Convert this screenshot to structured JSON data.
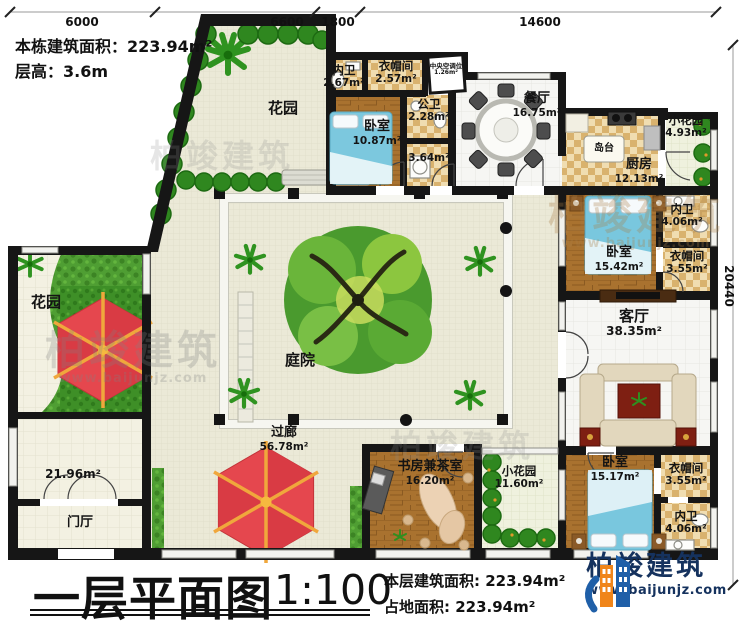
{
  "header": {
    "building_area_label": "本栋建筑面积：223.94m²",
    "floor_height_label": "层高：3.6m"
  },
  "dimensions": {
    "top": [
      "6000",
      "6600",
      "1800",
      "14600"
    ],
    "right": "20440"
  },
  "rooms": {
    "garden_top": {
      "name": "花园"
    },
    "neiwei1": {
      "name": "内卫",
      "area": "2.67m²"
    },
    "yimaojian1": {
      "name": "衣帽间",
      "area": "2.57m²"
    },
    "central_ac": {
      "name": "中央空调位",
      "area": "1.26m²"
    },
    "bedroom1": {
      "name": "卧室",
      "area": "10.87m²"
    },
    "gongwei": {
      "name": "公卫",
      "area": "2.28m²"
    },
    "laundry": {
      "area": "3.64m²"
    },
    "dining": {
      "name": "餐厅",
      "area": "16.75m²"
    },
    "island": {
      "name": "岛台"
    },
    "kitchen": {
      "name": "厨房",
      "area": "12.13m²"
    },
    "small_garden1": {
      "name": "小花园",
      "area": "4.93m²"
    },
    "neiwei2": {
      "name": "内卫",
      "area": "4.06m²"
    },
    "bedroom2": {
      "name": "卧室",
      "area": "15.42m²"
    },
    "yimaojian2": {
      "name": "衣帽间",
      "area": "3.55m²"
    },
    "living": {
      "name": "客厅",
      "area": "38.35m²"
    },
    "courtyard": {
      "name": "庭院"
    },
    "garden_left": {
      "name": "花园"
    },
    "corridor": {
      "name": "过廊",
      "area": "56.78m²"
    },
    "hall_area": {
      "area": "21.96m²"
    },
    "foyer": {
      "name": "门厅"
    },
    "study": {
      "name": "书房兼茶室",
      "area": "16.20m²"
    },
    "small_garden2": {
      "name": "小花园",
      "area": "11.60m²"
    },
    "bedroom3": {
      "name": "卧室",
      "area": "15.17m²"
    },
    "yimaojian3": {
      "name": "衣帽间",
      "area": "3.55m²"
    },
    "neiwei3": {
      "name": "内卫",
      "area": "4.06m²"
    }
  },
  "footer": {
    "title": "一层平面图",
    "scale": "1:100",
    "floor_area_label": "本层建筑面积: 223.94m²",
    "land_area_label": "占地面积: 223.94m²"
  },
  "logo": {
    "name": "柏竣建筑",
    "url": "www.baijunjz.com"
  },
  "watermark": {
    "text": "柏竣建筑",
    "url": "www.baijunjz.com"
  },
  "colors": {
    "wall": "#161616",
    "grass": "#4f9e33",
    "wood": "#a9722f",
    "bed_blue": "#7cc8de",
    "umbrella_red": "#e5474e",
    "logo_navy": "#15325e",
    "logo_orange": "#f08519"
  }
}
